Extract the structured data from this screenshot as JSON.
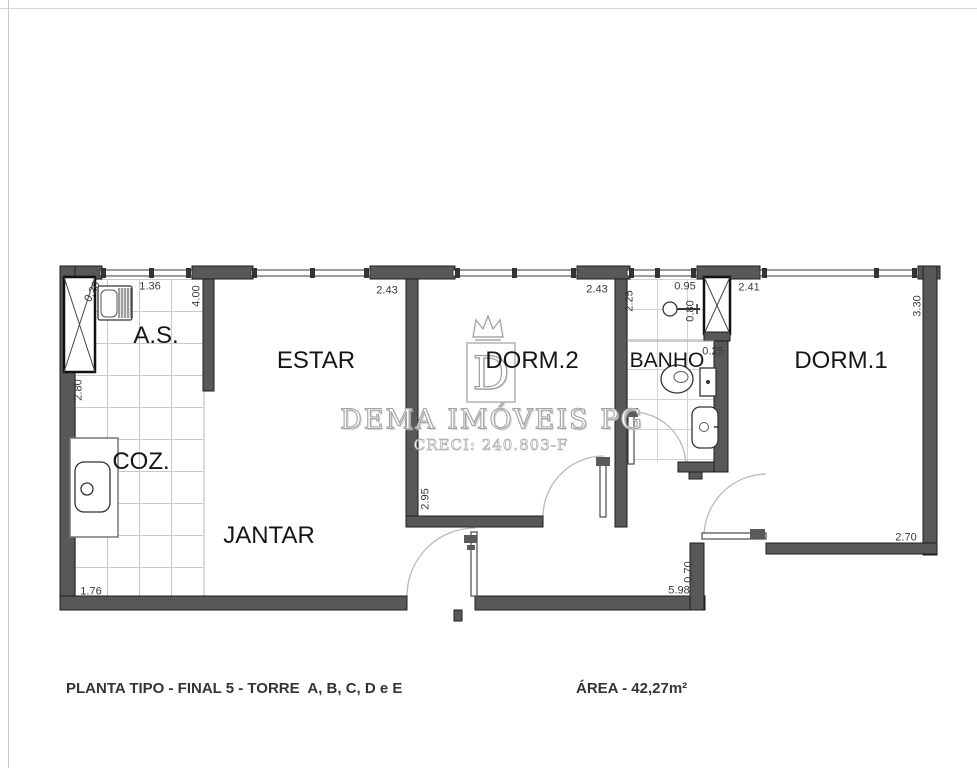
{
  "floorplan": {
    "rooms": [
      {
        "id": "as",
        "label": "A.S."
      },
      {
        "id": "estar",
        "label": "ESTAR"
      },
      {
        "id": "dorm2",
        "label": "DORM.2"
      },
      {
        "id": "banho",
        "label": "BANHO"
      },
      {
        "id": "dorm1",
        "label": "DORM.1"
      },
      {
        "id": "coz",
        "label": "COZ."
      },
      {
        "id": "jantar",
        "label": "JANTAR"
      }
    ],
    "dimensions": [
      {
        "id": "as-window",
        "label": "1.36"
      },
      {
        "id": "estar-depth",
        "label": "4.00"
      },
      {
        "id": "estar-window",
        "label": "2.43"
      },
      {
        "id": "dorm2-window",
        "label": "2.43"
      },
      {
        "id": "banho-depth",
        "label": "2.25"
      },
      {
        "id": "banho-width",
        "label": "0.95"
      },
      {
        "id": "dorm1-window",
        "label": "2.41"
      },
      {
        "id": "dorm1-depth",
        "label": "3.30"
      },
      {
        "id": "as-left",
        "label": "2.80"
      },
      {
        "id": "tank-gap",
        "label": "0.20"
      },
      {
        "id": "shower-width",
        "label": "0.80"
      },
      {
        "id": "shaft-ledge",
        "label": "0.25"
      },
      {
        "id": "dorm2-depth",
        "label": "2.95"
      },
      {
        "id": "dorm1-bottom",
        "label": "2.70"
      },
      {
        "id": "step",
        "label": "0.70"
      },
      {
        "id": "bottom-wall",
        "label": "5.98"
      },
      {
        "id": "coz-bottom",
        "label": "1.76"
      }
    ],
    "watermark": {
      "letter": "D",
      "name": "DEMA IMÓVEIS PG",
      "creci": "CRECI: 240.803-F"
    },
    "footer": {
      "plan_title": "PLANTA TIPO - FINAL 5 - TORRE  A, B, C, D e E",
      "area": "ÁREA - 42,27m²"
    },
    "colors": {
      "wall": "#585858",
      "wall_edge": "#1e1e1e",
      "tile_line": "#c9c9c9",
      "dimension_text": "#3a3a3a",
      "room_text": "#161616",
      "watermark_gray": "#a3a3a3"
    }
  }
}
